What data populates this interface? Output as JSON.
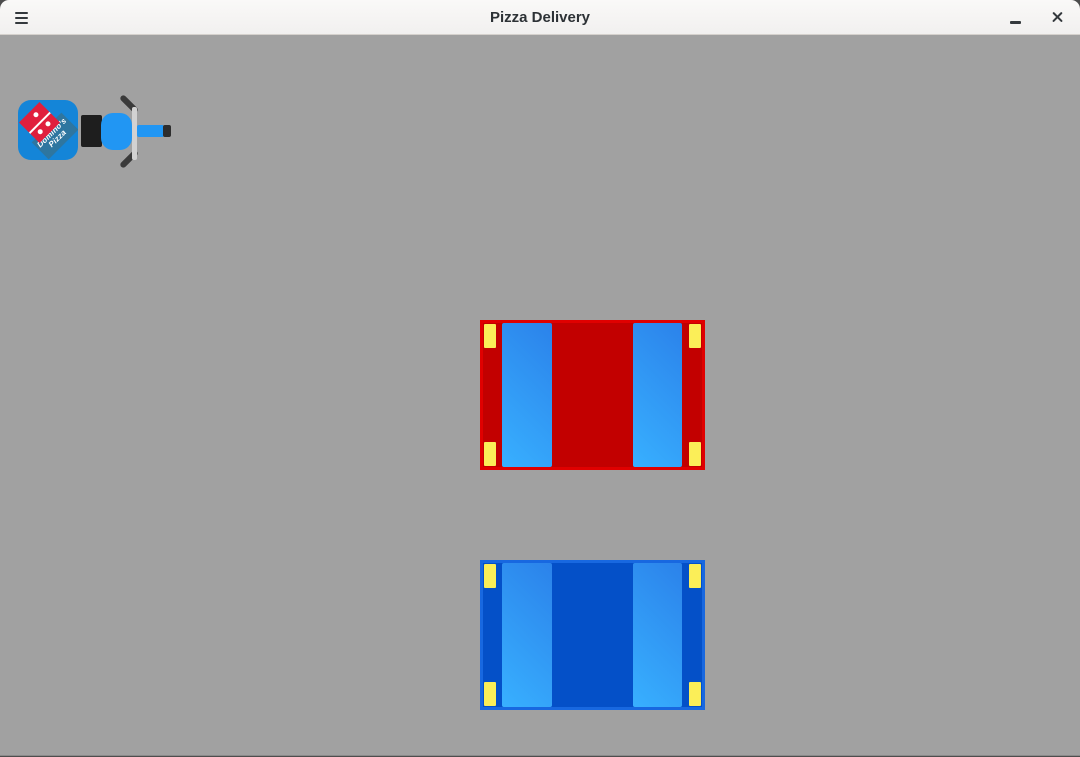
{
  "window": {
    "title": "Pizza Delivery"
  },
  "header": {
    "icons": [
      "hamburger-menu-icon",
      "minimize-icon",
      "close-icon"
    ]
  },
  "colors": {
    "canvas_bg": "#a1a1a1",
    "header_border": "#d5d1cd",
    "header_text": "#2d3236",
    "icon_color": "#34393d",
    "box_blue": "#1485d8",
    "logo_red": "#e01f3d",
    "logo_teal": "#2e76a0",
    "body_blue": "#2196f3",
    "seat_black": "#1e1e1e",
    "fork_gray": "#d2d2d2",
    "grip_dark": "#3a3a3a",
    "wheel_tip_dark": "#2d2d2d",
    "glass_dark": "#2b82ea",
    "glass_light": "#38b0ff",
    "headlight_yellow": "#fbee58"
  },
  "scooter": {
    "name": "delivery-scooter",
    "logo_line1": "Domino's",
    "logo_line2": "Pizza"
  },
  "cars": [
    {
      "name": "red-car",
      "body_color": "#c20000",
      "outline_color": "#e00000"
    },
    {
      "name": "blue-car",
      "body_color": "#0450c8",
      "outline_color": "#1868e0"
    }
  ]
}
